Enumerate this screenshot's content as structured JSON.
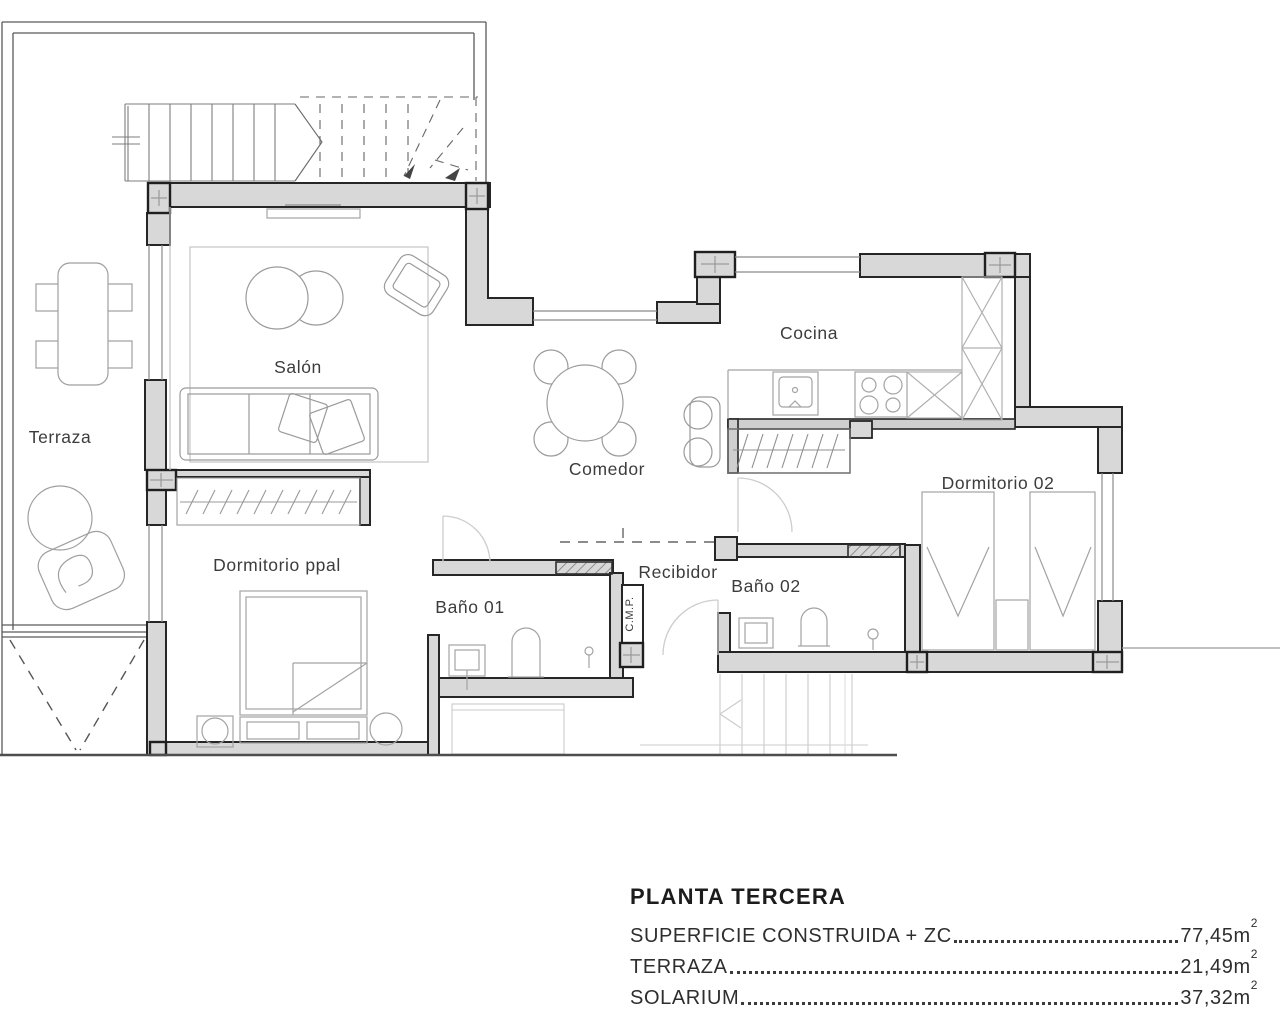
{
  "plan": {
    "rooms": {
      "terraza": {
        "label": "Terraza"
      },
      "salon": {
        "label": "Salón"
      },
      "comedor": {
        "label": "Comedor"
      },
      "cocina": {
        "label": "Cocina"
      },
      "dormitorio02": {
        "label": "Dormitorio 02"
      },
      "dormitorio_ppal": {
        "label": "Dormitorio ppal"
      },
      "bano01": {
        "label": "Baño 01"
      },
      "recibidor": {
        "label": "Recibidor"
      },
      "bano02": {
        "label": "Baño 02"
      },
      "cmp": {
        "label": "C.M.P."
      }
    }
  },
  "summary": {
    "title": "PLANTA TERCERA",
    "rows": [
      {
        "label": "SUPERFICIE CONSTRUIDA + ZC",
        "value": "77,45m",
        "exp": "2"
      },
      {
        "label": "TERRAZA",
        "value": "21,49m",
        "exp": "2"
      },
      {
        "label": "SOLARIUM",
        "value": "37,32m",
        "exp": "2"
      }
    ]
  },
  "colors": {
    "wall_fill": "#d8d8d8",
    "wall_outline": "#262626",
    "furniture_line": "#a3a3a3",
    "label_text": "#3c3c3c",
    "background": "#ffffff"
  }
}
